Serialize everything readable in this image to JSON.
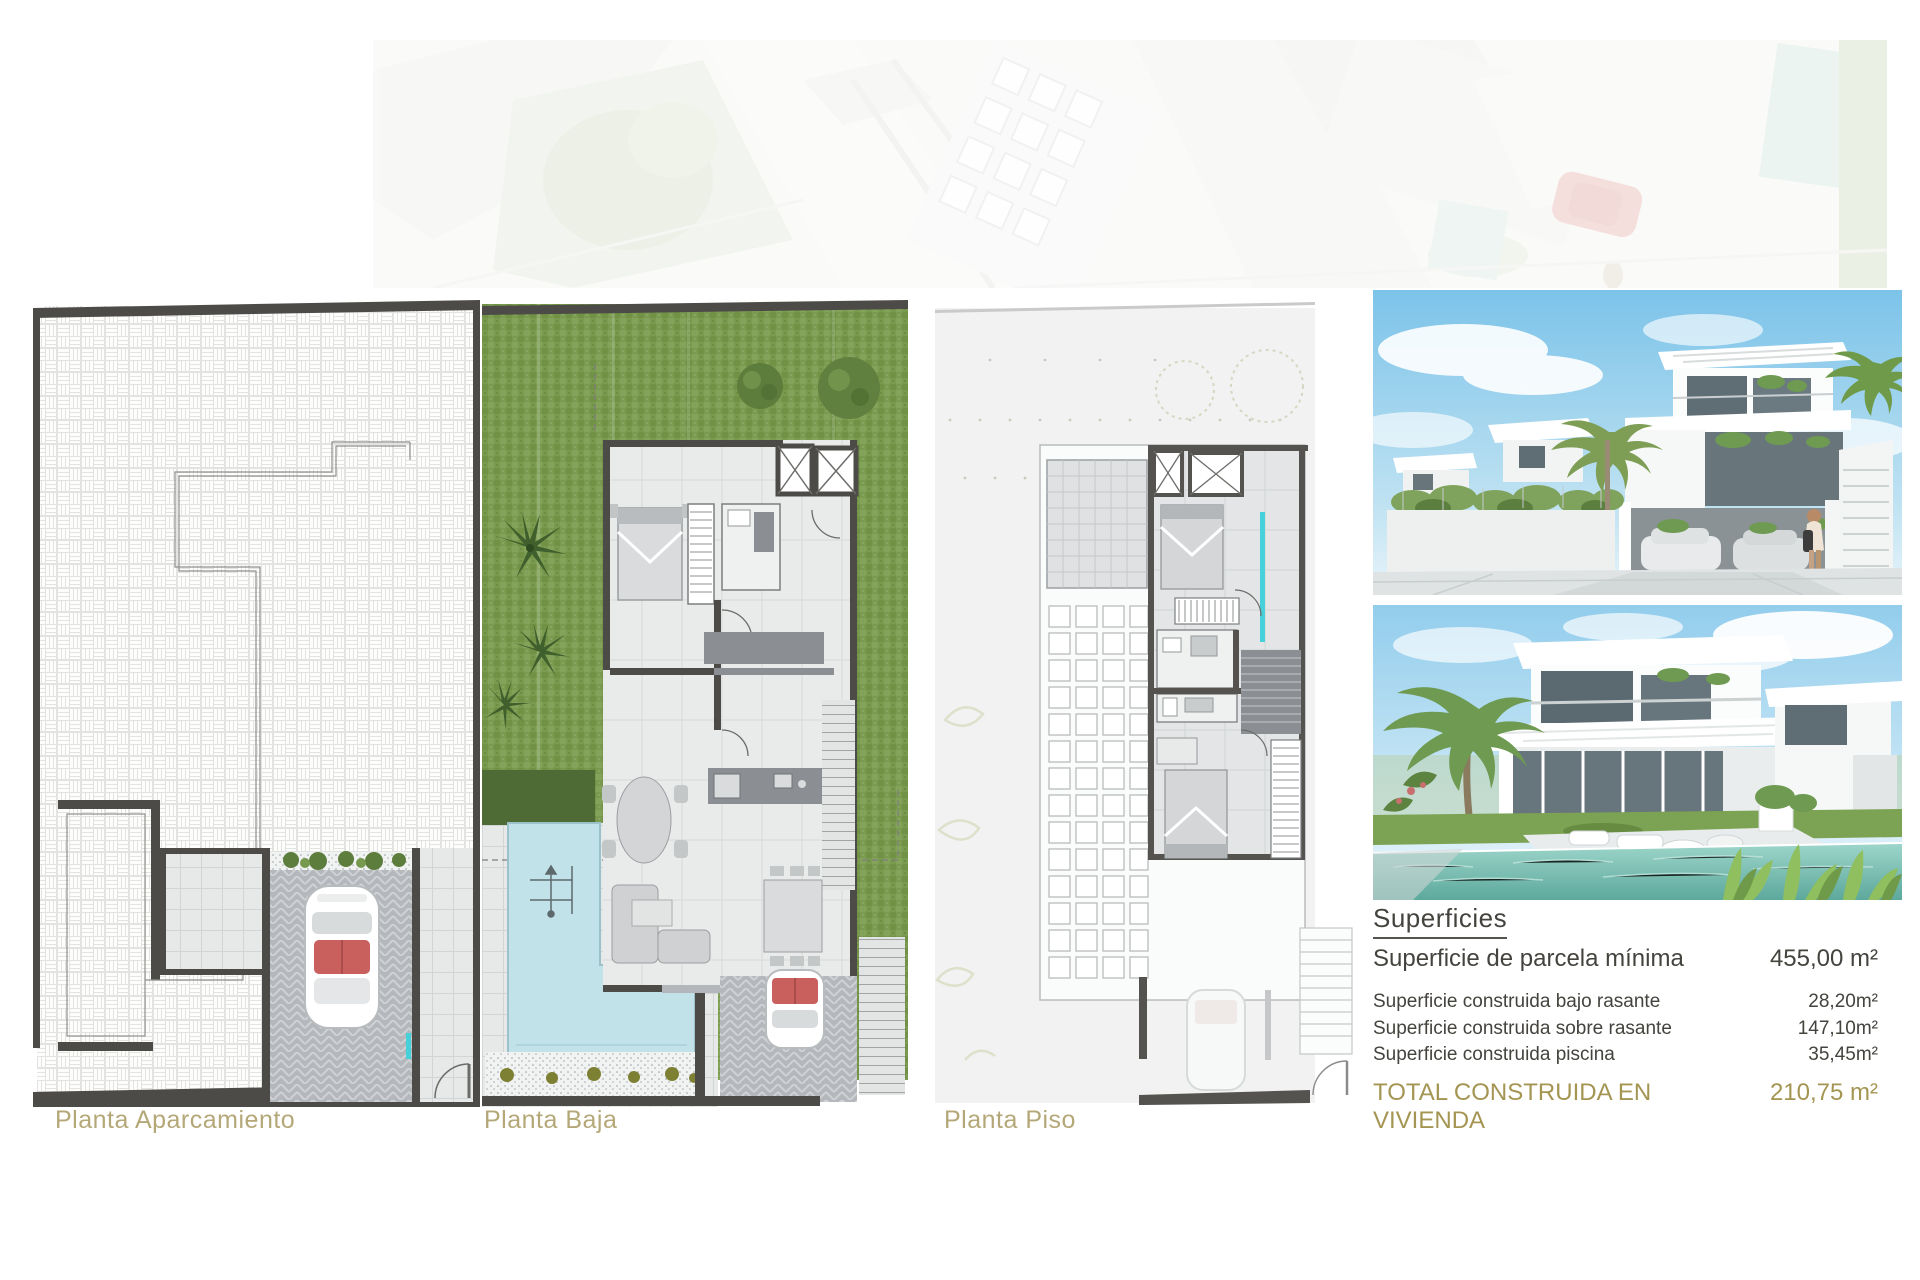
{
  "document": {
    "type": "real-estate plan sheet",
    "language": "es"
  },
  "plans": [
    {
      "id": "planta-aparcamiento",
      "label": "Planta Aparcamiento"
    },
    {
      "id": "planta-baja",
      "label": "Planta Baja"
    },
    {
      "id": "planta-piso",
      "label": "Planta Piso"
    }
  ],
  "superficies": {
    "title": "Superficies",
    "rows": [
      {
        "label": "Superficie de parcela mínima",
        "value": "455,00 m²"
      },
      {
        "label": "Superficie construida bajo rasante",
        "value": "28,20m²"
      },
      {
        "label": "Superficie construida sobre rasante",
        "value": "147,10m²"
      },
      {
        "label": "Superficie construida piscina",
        "value": "35,45m²"
      }
    ],
    "total": {
      "label": "TOTAL CONSTRUIDA EN VIVIENDA",
      "value": "210,75 m²"
    }
  },
  "colors": {
    "text_dark": "#44433e",
    "accent_olive_total": "#a49552",
    "caption_olive": "#b5a878",
    "plan_wall": "#4c4b47",
    "grass_green": "#7a9a50",
    "pool_blue": "#bfdfe7",
    "glass_cyan": "#45d0da",
    "sky_blue": "#8fcdec",
    "tile_gray": "#e7e8e8",
    "driveway_gray": "#b3b7bb"
  }
}
